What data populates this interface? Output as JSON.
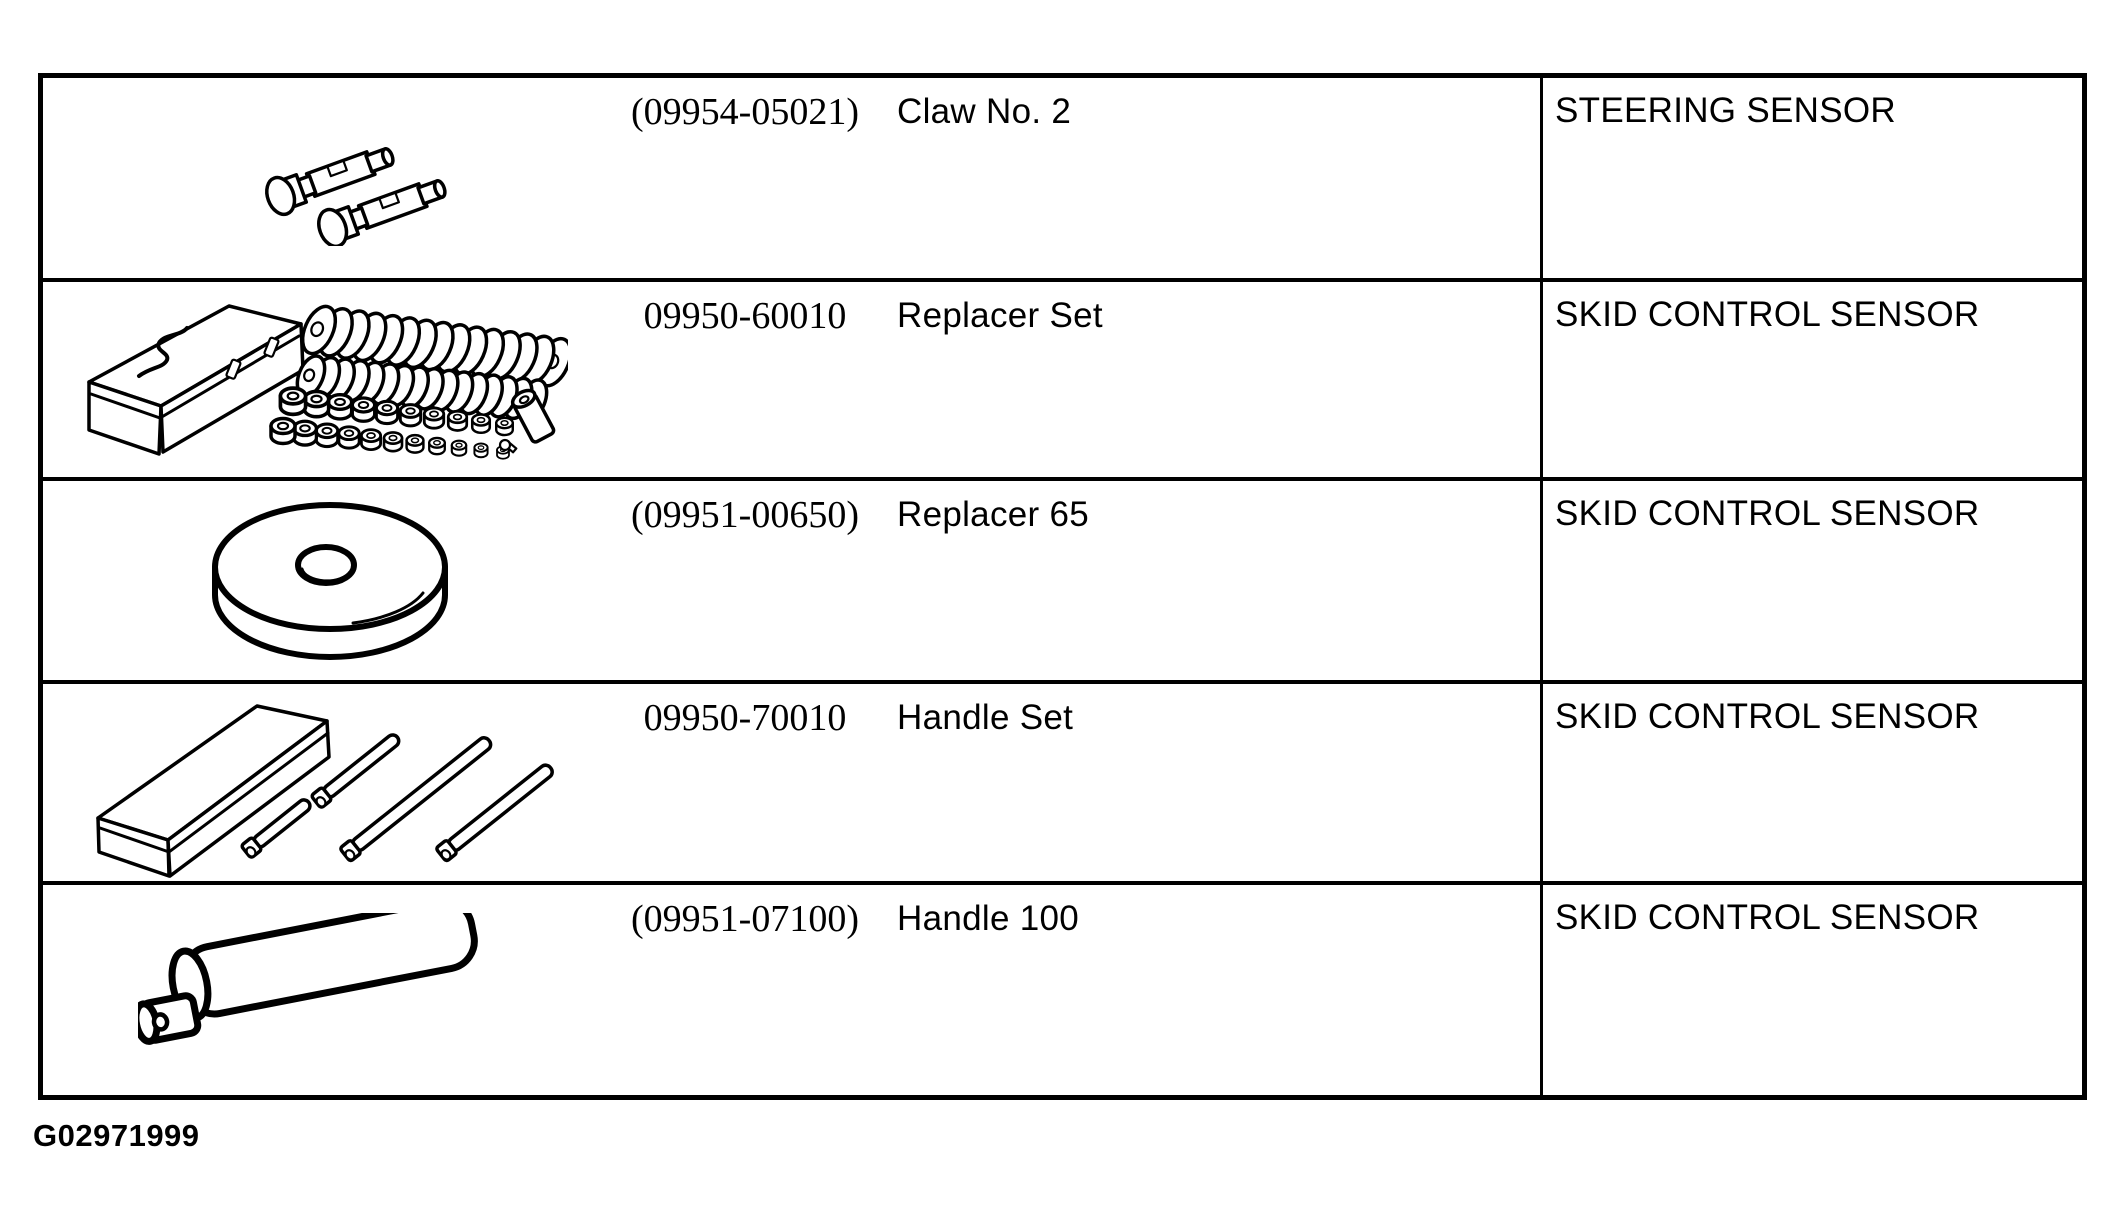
{
  "document": {
    "background_color": "#ffffff",
    "line_color": "#000000",
    "figure_code": "G02971999"
  },
  "table": {
    "columns": [
      "illustration",
      "part_number",
      "tool_name",
      "application"
    ],
    "rows": [
      {
        "part_number": "(09954-05021)",
        "tool_name": "Claw No. 2",
        "application": "STEERING SENSOR",
        "illustration": "two-claw-bolts"
      },
      {
        "part_number": "09950-60010",
        "tool_name": "Replacer Set",
        "application": "SKID CONTROL SENSOR",
        "illustration": "toolbox-with-washer-set"
      },
      {
        "part_number": "(09951-00650)",
        "tool_name": "Replacer 65",
        "application": "SKID CONTROL SENSOR",
        "illustration": "replacer-disc"
      },
      {
        "part_number": "09950-70010",
        "tool_name": "Handle Set",
        "application": "SKID CONTROL SENSOR",
        "illustration": "case-with-handle-rods"
      },
      {
        "part_number": "(09951-07100)",
        "tool_name": "Handle 100",
        "application": "SKID CONTROL SENSOR",
        "illustration": "cylindrical-handle"
      }
    ]
  }
}
